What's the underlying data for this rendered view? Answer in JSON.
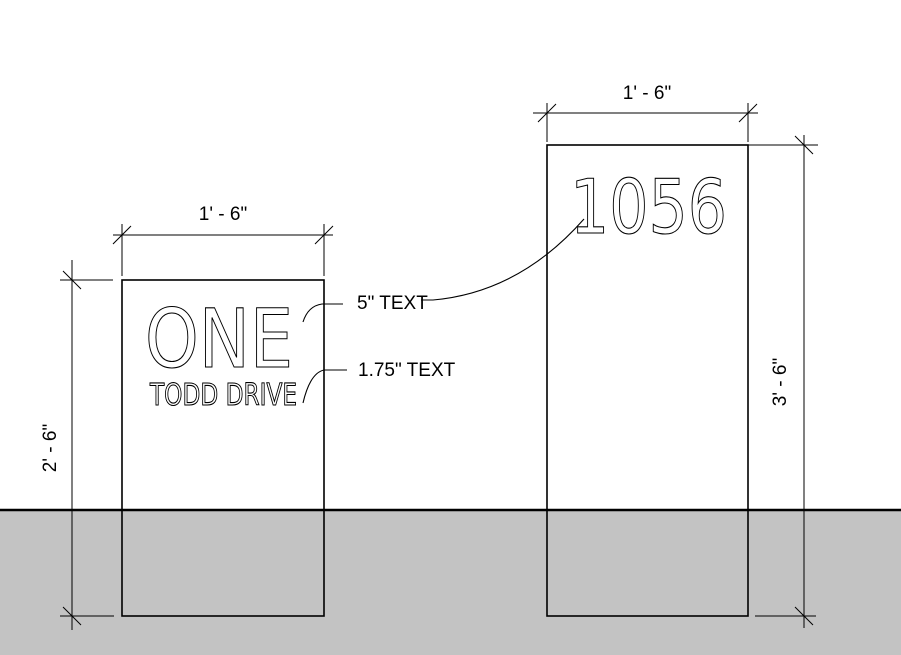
{
  "drawing": {
    "left_sign": {
      "line1": "ONE",
      "line2": "TODD DRIVE",
      "width_dim": "1' - 6\"",
      "height_dim": "2' - 6\""
    },
    "right_sign": {
      "number": "1056",
      "width_dim": "1' - 6\"",
      "height_dim": "3' - 6\""
    },
    "annotations": {
      "large_text_note": "5\" TEXT",
      "small_text_note": "1.75\" TEXT"
    },
    "colors": {
      "ground": "#c3c3c3",
      "line": "#000000",
      "background": "#ffffff"
    }
  }
}
